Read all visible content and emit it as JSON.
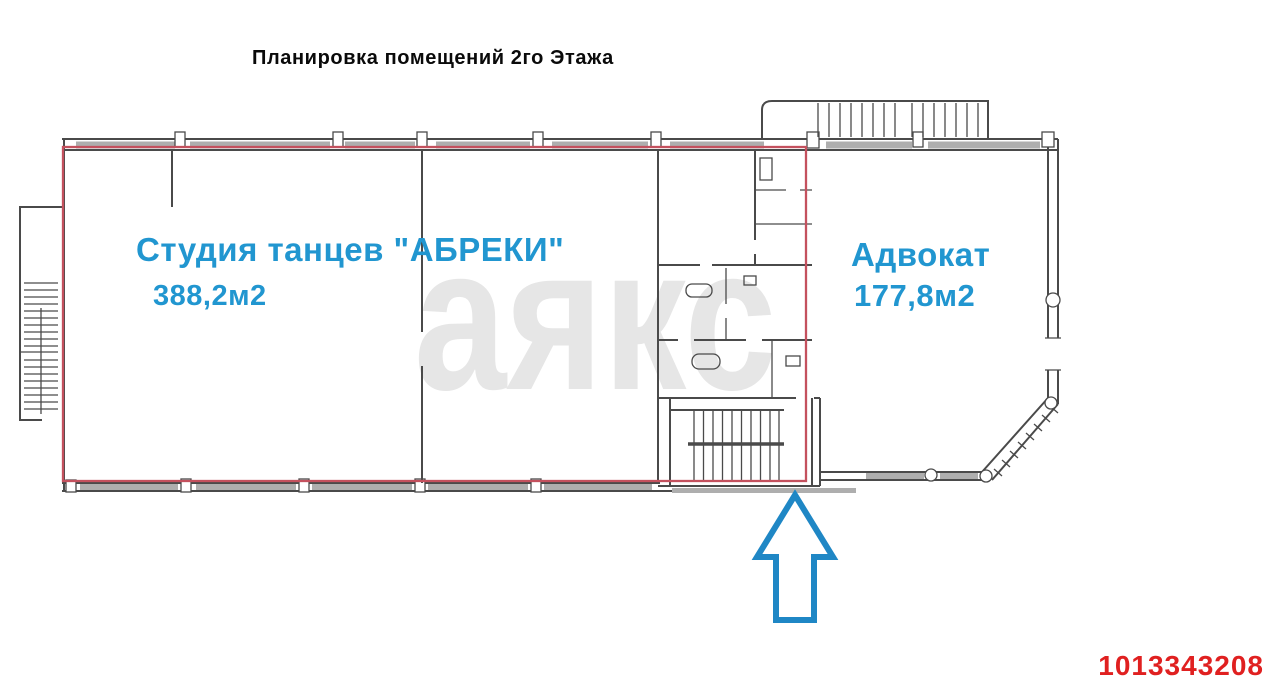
{
  "page": {
    "title": "Планировка помещений 2го Этажа"
  },
  "watermark": {
    "text": "аякс"
  },
  "rooms": {
    "studio": {
      "name": "Студия танцев \"АБРЕКИ\"",
      "area": "388,2м2"
    },
    "advokat": {
      "name": "Адвокат",
      "area": "177,8м2"
    }
  },
  "listing": {
    "id": "1013343208"
  },
  "icons": {
    "entrance_arrow": "up-arrow"
  },
  "colors": {
    "label_blue": "#2196d0",
    "outline_red": "#c4515e",
    "arrow_blue": "#1f87c5",
    "id_red": "#e02020",
    "watermark_gray": "#e6e6e6",
    "wall_gray": "#4a4a4a"
  }
}
